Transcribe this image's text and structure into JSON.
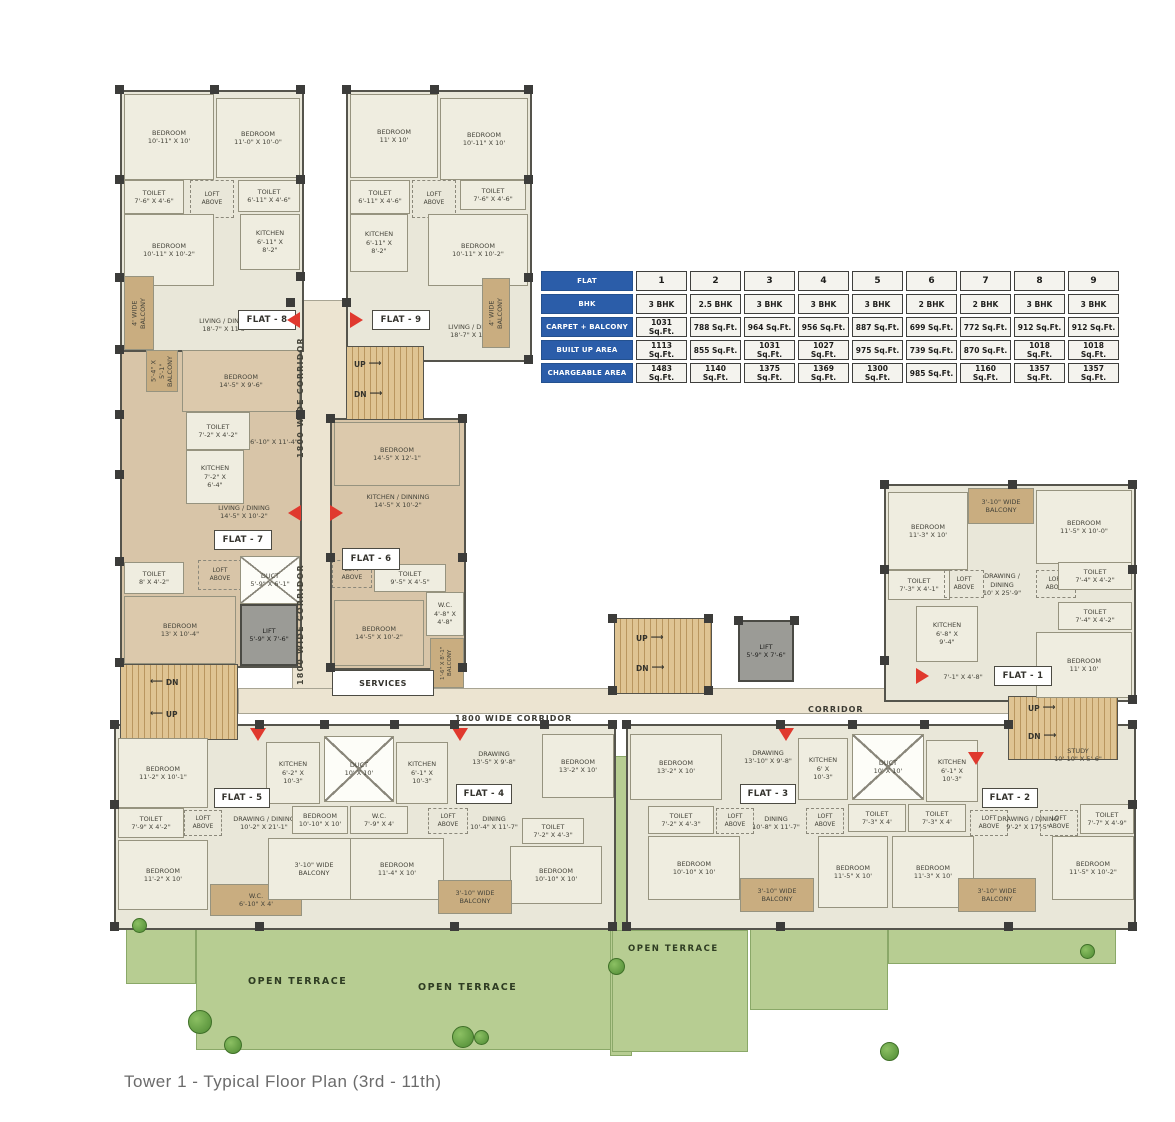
{
  "caption": "Tower 1 - Typical Floor Plan (3rd - 11th)",
  "table": {
    "corner": "FLAT",
    "columns": [
      "1",
      "2",
      "3",
      "4",
      "5",
      "6",
      "7",
      "8",
      "9"
    ],
    "rows": [
      {
        "label": "BHK",
        "values": [
          "3 BHK",
          "2.5 BHK",
          "3 BHK",
          "3 BHK",
          "3 BHK",
          "2 BHK",
          "2 BHK",
          "3 BHK",
          "3 BHK"
        ]
      },
      {
        "label": "CARPET + BALCONY",
        "values": [
          "1031 Sq.Ft.",
          "788 Sq.Ft.",
          "964 Sq.Ft.",
          "956 Sq.Ft.",
          "887 Sq.Ft.",
          "699 Sq.Ft.",
          "772 Sq.Ft.",
          "912 Sq.Ft.",
          "912 Sq.Ft."
        ]
      },
      {
        "label": "BUILT UP AREA",
        "values": [
          "1113 Sq.Ft.",
          "855 Sq.Ft.",
          "1031 Sq.Ft.",
          "1027 Sq.Ft.",
          "975 Sq.Ft.",
          "739 Sq.Ft.",
          "870 Sq.Ft.",
          "1018 Sq.Ft.",
          "1018 Sq.Ft."
        ]
      },
      {
        "label": "CHARGEABLE AREA",
        "values": [
          "1483 Sq.Ft.",
          "1140 Sq.Ft.",
          "1375 Sq.Ft.",
          "1369 Sq.Ft.",
          "1300 Sq.Ft.",
          "985 Sq.Ft.",
          "1160 Sq.Ft.",
          "1357 Sq.Ft.",
          "1357 Sq.Ft."
        ]
      }
    ]
  },
  "labels": {
    "up": "UP",
    "dn": "DN",
    "services": "SERVICES",
    "corridor_v": "1800 WIDE CORRIDOR",
    "corridor_h": "1800 WIDE CORRIDOR",
    "corridor": "CORRIDOR",
    "open_terrace": "OPEN TERRACE",
    "arrow_left": "⟵",
    "arrow_right": "⟶",
    "lift": "LIFT\n5'-9\" X 7'-6\"",
    "duct_large": "DUCT\n10' X 10'"
  },
  "flats": {
    "flat8": {
      "tag": "FLAT - 8",
      "rooms": [
        "BEDROOM\n10'-11\" X 10'",
        "BEDROOM\n11'-0\" X 10'-0\"",
        "TOILET\n7'-6\" X 4'-6\"",
        "LOFT\nABOVE",
        "TOILET\n6'-11\" X 4'-6\"",
        "BEDROOM\n10'-11\" X 10'-2\"",
        "KITCHEN\n6'-11\" X\n8'-2\"",
        "LIVING / DINING\n18'-7\" X 11'6\"",
        "4' WIDE\nBALCONY"
      ]
    },
    "flat9": {
      "tag": "FLAT - 9",
      "rooms": [
        "BEDROOM\n11' X 10'",
        "BEDROOM\n10'-11\" X 10'",
        "TOILET\n6'-11\" X 4'-6\"",
        "LOFT\nABOVE",
        "TOILET\n7'-6\" X 4'-6\"",
        "KITCHEN\n6'-11\" X\n8'-2\"",
        "BEDROOM\n10'-11\" X 10'-2\"",
        "LIVING / DINING\n18'-7\" X 11'-4\"",
        "4' WIDE\nBALCONY"
      ]
    },
    "flat7": {
      "tag": "FLAT - 7",
      "rooms": [
        "5'-4\" X 5'-1\"\nBALCONY",
        "BEDROOM\n14'-5\" X 9'-6\"",
        "TOILET\n7'-2\" X 4'-2\"",
        "KITCHEN\n7'-2\" X\n6'-4\"",
        "6'-10\" X 11'-4\"",
        "LIVING / DINING\n14'-5\" X 10'-2\"",
        "TOILET\n8' X 4'-2\"",
        "LOFT\nABOVE",
        "DUCT\n5'-9\" X 6'-1\"",
        "BEDROOM\n13' X 10'-4\"",
        "LIFT\n5'-9\" X 7'-6\""
      ]
    },
    "flat6": {
      "tag": "FLAT - 6",
      "rooms": [
        "BEDROOM\n14'-5\" X 12'-1\"",
        "KITCHEN / DINNING\n14'-5\" X 10'-2\"",
        "LOFT\nABOVE",
        "TOILET\n9'-5\" X 4'-5\"",
        "W.C.\n4'-8\" X\n4'-8\"",
        "BEDROOM\n14'-5\" X 10'-2\"",
        "1'-6\" X 8'-1\"\nBALCONY"
      ]
    },
    "flat1": {
      "tag": "FLAT - 1",
      "rooms": [
        "3'-10\" WIDE\nBALCONY",
        "BEDROOM\n11'-3\" X 10'",
        "BEDROOM\n11'-5\" X 10'-0\"",
        "TOILET\n7'-3\" X 4'-1\"",
        "LOFT\nABOVE",
        "DRAWING /\nDINING\n10' X 25'-9\"",
        "LOFT\nABOVE",
        "TOILET\n7'-4\" X 4'-2\"",
        "TOILET\n7'-4\" X 4'-2\"",
        "KITCHEN\n6'-8\" X\n9'-4\"",
        "BEDROOM\n11' X 10'",
        "7'-1\" X 4'-8\""
      ]
    },
    "flat5": {
      "tag": "FLAT - 5",
      "rooms": [
        "BEDROOM\n11'-2\" X 10'-1\"",
        "TOILET\n7'-9\" X 4'-2\"",
        "LOFT\nABOVE",
        "BEDROOM\n11'-2\" X 10'",
        "DRAWING / DINING\n10'-2\" X 21'-1\"",
        "KITCHEN\n6'-2\" X\n10'-3\"",
        "W.C.\n6'-10\" X 4'",
        "BEDROOM\n10'-10\" X 10'",
        "3'-10\" WIDE\nBALCONY"
      ]
    },
    "flat4": {
      "tag": "FLAT - 4",
      "rooms": [
        "KITCHEN\n6'-1\" X\n10'-3\"",
        "W.C.\n7'-9\" X 4'",
        "LOFT\nABOVE",
        "BEDROOM\n11'-4\" X 10'",
        "DRAWING\n13'-5\" X 9'-8\"",
        "BEDROOM\n13'-2\" X 10'",
        "DINING\n10'-4\" X 11'-7\"",
        "TOILET\n7'-2\" X 4'-3\"",
        "BEDROOM\n10'-10\" X 10'",
        "3'-10\" WIDE\nBALCONY"
      ]
    },
    "flat3": {
      "tag": "FLAT - 3",
      "rooms": [
        "BEDROOM\n13'-2\" X 10'",
        "DRAWING\n13'-10\" X 9'-8\"",
        "KITCHEN\n6' X\n10'-3\"",
        "TOILET\n7'-2\" X 4'-3\"",
        "LOFT\nABOVE",
        "DINING\n10'-8\" X 11'-7\"",
        "LOFT\nABOVE",
        "BEDROOM\n10'-10\" X 10'",
        "3'-10\" WIDE\nBALCONY",
        "BEDROOM\n11'-5\" X 10'"
      ]
    },
    "flat2": {
      "tag": "FLAT - 2",
      "rooms": [
        "KITCHEN\n6'-1\" X\n10'-3\"",
        "TOILET\n7'-3\" X 4'",
        "TOILET\n7'-3\" X 4'",
        "BEDROOM\n11'-3\" X 10'",
        "LOFT\nABOVE",
        "DRAWING / DINING\n9'-2\" X 17'-5\"",
        "STUDY\n10'-10\" X 5'-6\"",
        "LOFT\nABOVE",
        "TOILET\n7'-7\" X 4'-9\"",
        "BEDROOM\n11'-5\" X 10'-2\"",
        "3'-10\" WIDE\nBALCONY"
      ]
    }
  }
}
